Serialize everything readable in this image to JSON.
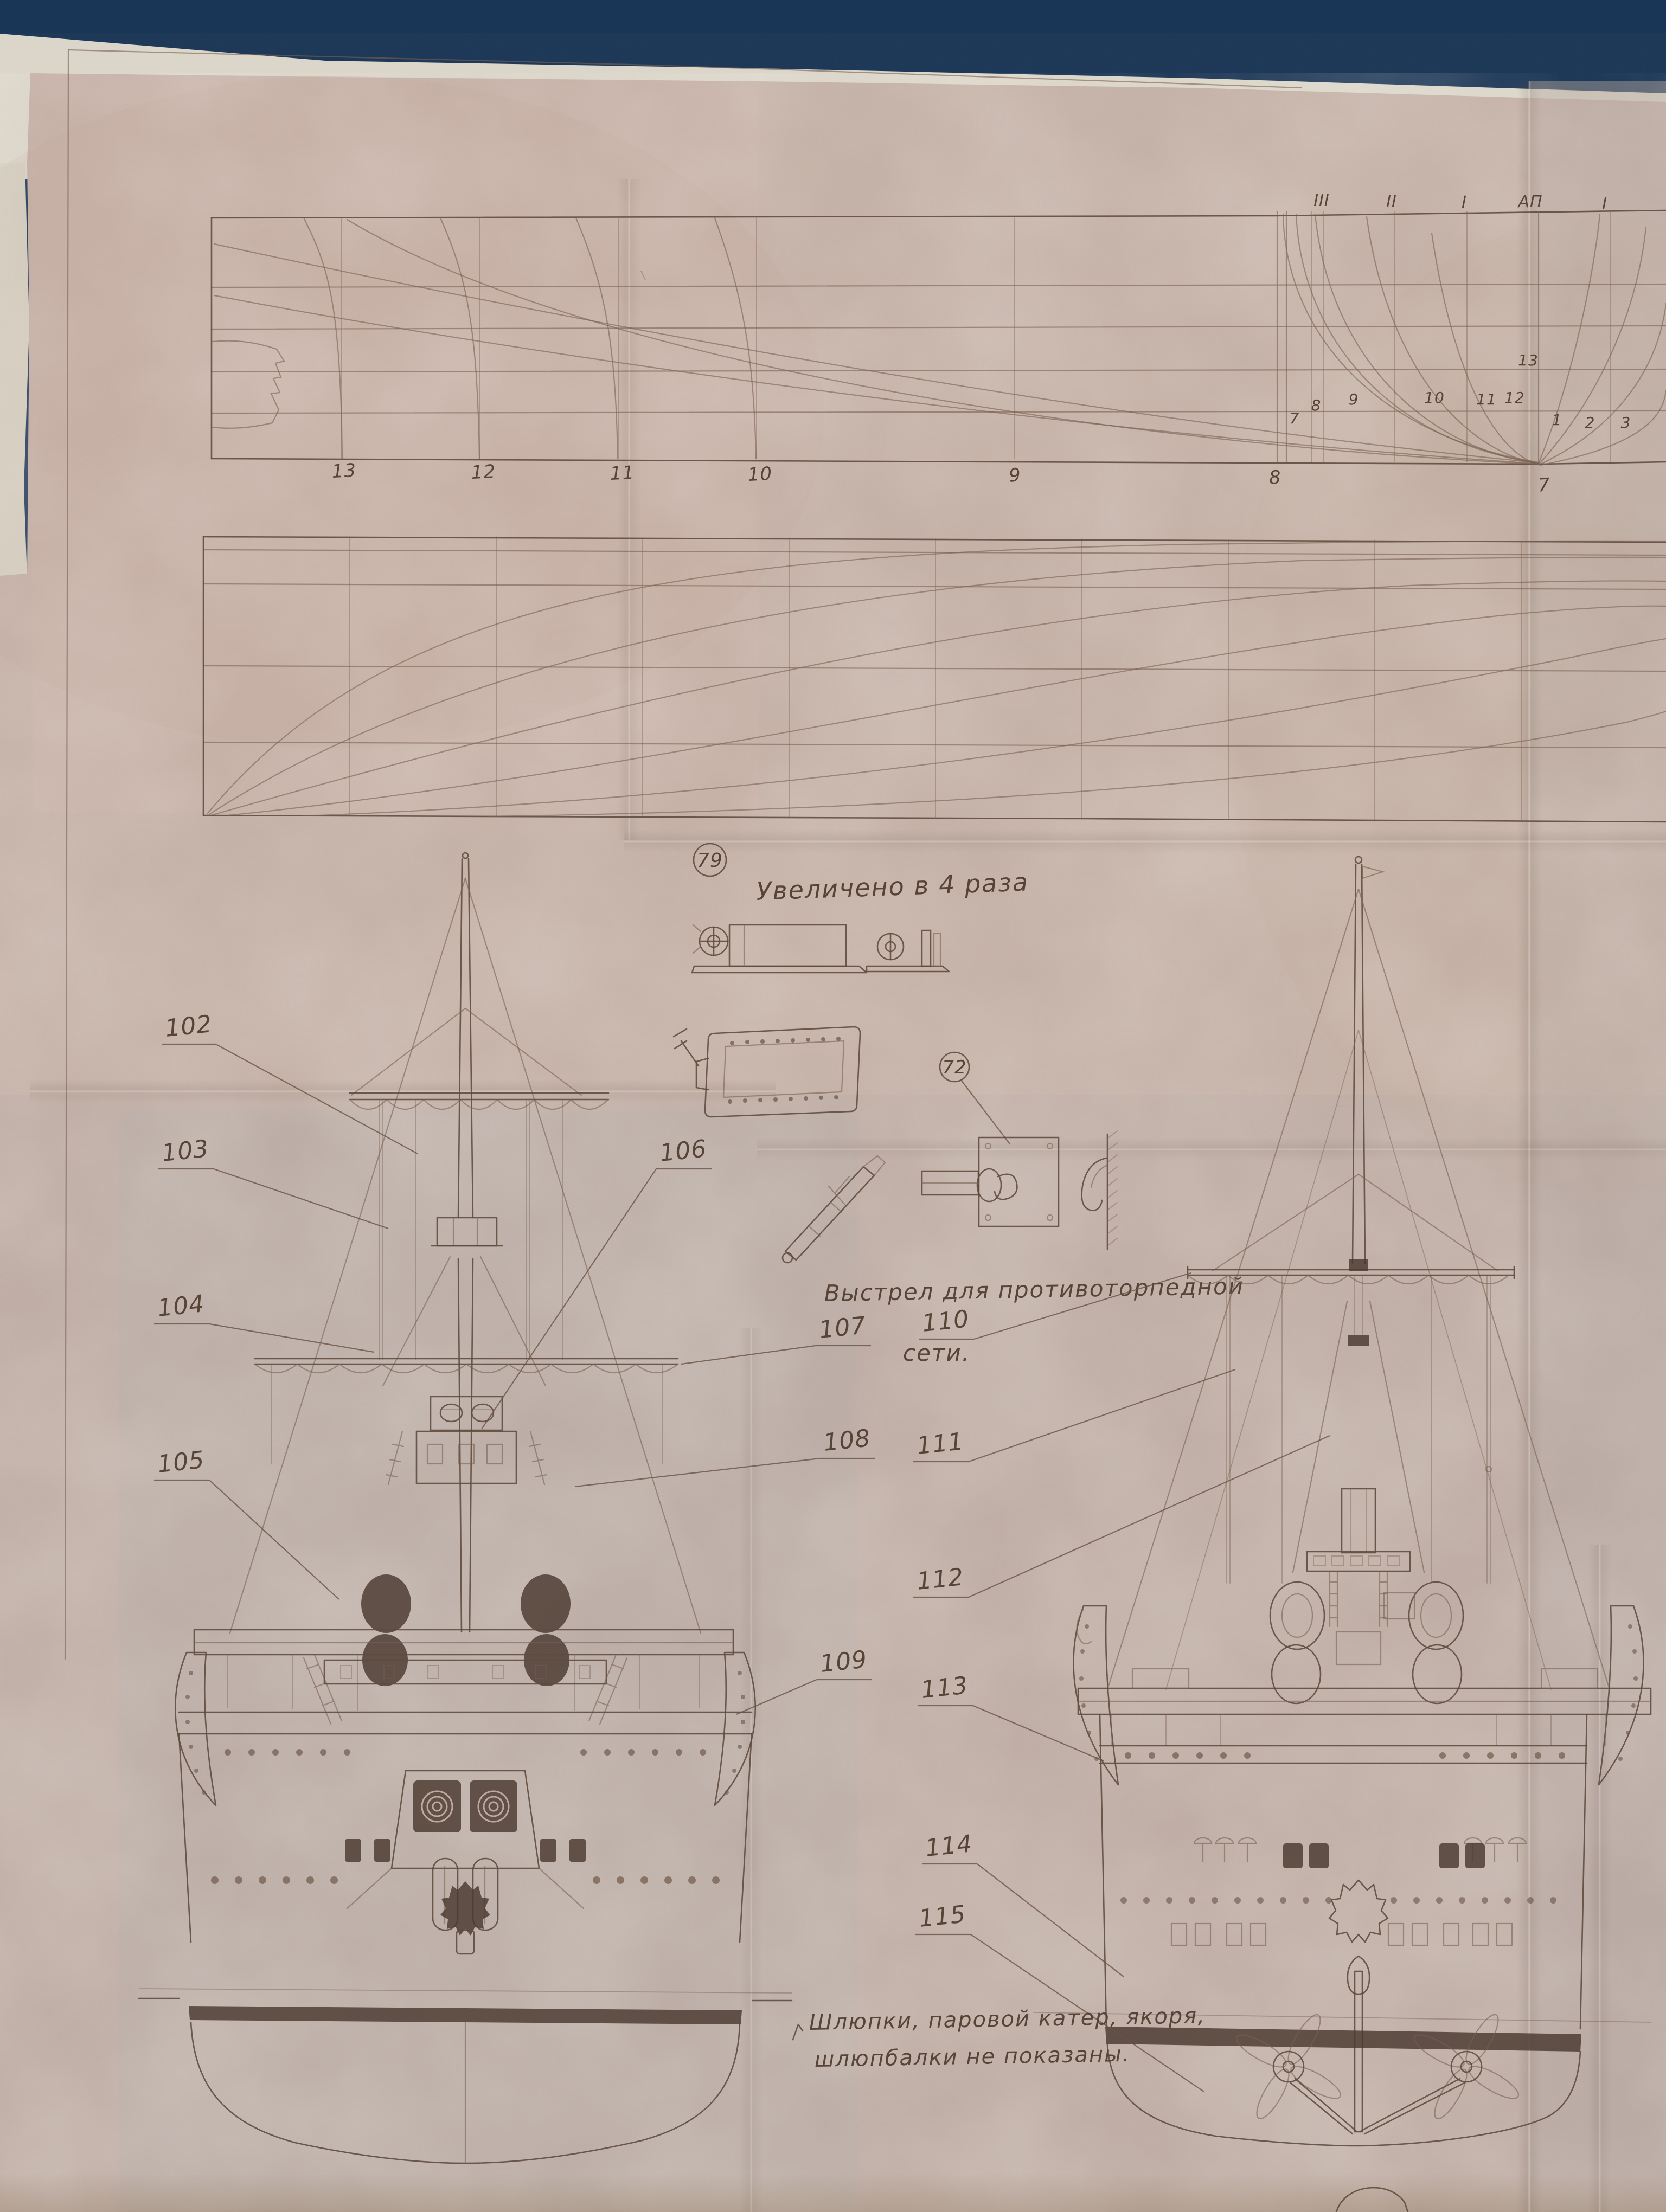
{
  "details": {
    "d79": {
      "number": "79",
      "caption": "Увеличено в 4 раза"
    },
    "d72": {
      "number": "72",
      "note_line1": "Выстрел для противоторпедной",
      "note_line2": "сети."
    }
  },
  "footnote": {
    "line1": "Шлюпки, паровой катер, якоря,",
    "line2": "шлюпбалки не показаны."
  },
  "callouts": {
    "c102": "102",
    "c103": "103",
    "c104": "104",
    "c105": "105",
    "c106": "106",
    "c107": "107",
    "c108": "108",
    "c109": "109",
    "c110": "110",
    "c111": "111",
    "c112": "112",
    "c113": "113",
    "c114": "114",
    "c115": "115"
  },
  "lines_plan": {
    "station_labels": [
      "13",
      "12",
      "11",
      "10",
      "9",
      "8",
      "7"
    ],
    "buttock_labels": [
      "III",
      "II",
      "I",
      "АП",
      "I"
    ],
    "frame_labels": [
      "13",
      "12",
      "11",
      "10",
      "9",
      "8",
      "7",
      "1",
      "2",
      "3"
    ]
  },
  "colors": {
    "backdrop": "#1c3a5e",
    "paper": "#c6b3a9",
    "paper_edge": "#ded9cd",
    "ink": "#5f4a3c",
    "ink_faint": "#7a6151",
    "ink_dark": "#4a3930"
  }
}
